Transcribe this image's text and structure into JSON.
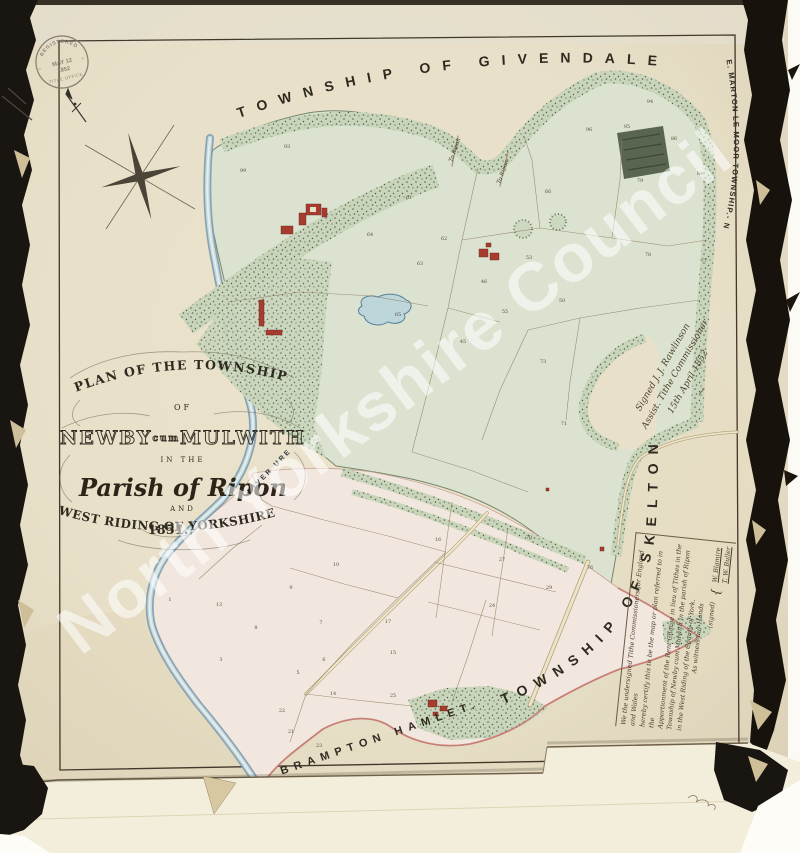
{
  "doc": {
    "watermark": "North Yorkshire Council",
    "stamp": {
      "arc_top": "REGISTERED",
      "line1": "MAY 12",
      "line2": "1852",
      "arc_bottom": "TITHE OFFICE"
    },
    "cartouche": {
      "line1": "PLAN OF THE TOWNSHIP",
      "line2": "OF",
      "name_a": "NEWBY",
      "name_b": "cum",
      "name_c": "MULWITH",
      "line4": "IN THE",
      "line5": "Parish of Ripon",
      "line6": "AND",
      "line7": "WEST RIDING OF YORKSHIRE",
      "line8": "1851."
    },
    "boundary_labels": {
      "north": "TOWNSHIP OF GIVENDALE",
      "northeast": "E. MARTON LE MOOR TOWNSHIP.- N",
      "east": "TOWNSHIP OF SKELTON",
      "south": "BRAMPTON HAMLET."
    },
    "map_labels": {
      "river": "RIVER URE",
      "road_north_1": "To Ripon",
      "road_north_2": "To Ripon"
    },
    "signature_block": {
      "line1": "Signed  J. J. Rawlinson",
      "line2": "Assist. Tithe Commissioner",
      "line3": "15th April 1852",
      "flourish": "~"
    },
    "certification": {
      "lines": [
        "We the undersigned Tithe Commissioners for England and Wales",
        "hereby certify this to be the map or plan referred to in the",
        "Apportionment of the Rent Charge in lieu of Tithes in the",
        "Township of Newby cum Mulwith in the parish of Ripon",
        "in the West Riding of the County of York.",
        "As witness our Hands"
      ],
      "signed_label": "(signed)",
      "signatories": [
        "W. Blamire",
        "T. W. Buller"
      ]
    },
    "parcel_numbers": [
      {
        "n": "93",
        "x": 287,
        "y": 148
      },
      {
        "n": "99",
        "x": 243,
        "y": 172
      },
      {
        "n": "94",
        "x": 650,
        "y": 103
      },
      {
        "n": "95",
        "x": 627,
        "y": 128
      },
      {
        "n": "96",
        "x": 589,
        "y": 131
      },
      {
        "n": "86",
        "x": 674,
        "y": 140
      },
      {
        "n": "84",
        "x": 700,
        "y": 175
      },
      {
        "n": "79",
        "x": 640,
        "y": 182
      },
      {
        "n": "77",
        "x": 704,
        "y": 262
      },
      {
        "n": "78",
        "x": 648,
        "y": 256
      },
      {
        "n": "61",
        "x": 409,
        "y": 199
      },
      {
        "n": "62",
        "x": 444,
        "y": 240
      },
      {
        "n": "63",
        "x": 420,
        "y": 265
      },
      {
        "n": "64",
        "x": 370,
        "y": 236
      },
      {
        "n": "65",
        "x": 398,
        "y": 316
      },
      {
        "n": "66",
        "x": 548,
        "y": 193
      },
      {
        "n": "53",
        "x": 529,
        "y": 259
      },
      {
        "n": "55",
        "x": 505,
        "y": 313
      },
      {
        "n": "46",
        "x": 484,
        "y": 283
      },
      {
        "n": "45",
        "x": 463,
        "y": 343
      },
      {
        "n": "50",
        "x": 562,
        "y": 302
      },
      {
        "n": "71",
        "x": 564,
        "y": 425
      },
      {
        "n": "73",
        "x": 543,
        "y": 363
      },
      {
        "n": "70",
        "x": 529,
        "y": 539
      },
      {
        "n": "76",
        "x": 590,
        "y": 569
      },
      {
        "n": "27",
        "x": 502,
        "y": 561
      },
      {
        "n": "16",
        "x": 438,
        "y": 541
      },
      {
        "n": "29",
        "x": 549,
        "y": 589
      },
      {
        "n": "24",
        "x": 492,
        "y": 607
      },
      {
        "n": "1",
        "x": 170,
        "y": 601
      },
      {
        "n": "13",
        "x": 219,
        "y": 606
      },
      {
        "n": "9",
        "x": 291,
        "y": 589
      },
      {
        "n": "7",
        "x": 321,
        "y": 624
      },
      {
        "n": "8",
        "x": 256,
        "y": 629
      },
      {
        "n": "3",
        "x": 221,
        "y": 661
      },
      {
        "n": "5",
        "x": 298,
        "y": 674
      },
      {
        "n": "6",
        "x": 324,
        "y": 661
      },
      {
        "n": "10",
        "x": 336,
        "y": 566
      },
      {
        "n": "17",
        "x": 388,
        "y": 623
      },
      {
        "n": "15",
        "x": 393,
        "y": 654
      },
      {
        "n": "25",
        "x": 393,
        "y": 697
      },
      {
        "n": "14",
        "x": 333,
        "y": 695
      },
      {
        "n": "21",
        "x": 291,
        "y": 733
      },
      {
        "n": "23",
        "x": 319,
        "y": 747
      },
      {
        "n": "22",
        "x": 282,
        "y": 712
      }
    ],
    "colors": {
      "paper": "#e9e1c9",
      "green_area": "#dbe3d0",
      "pink_area": "#f1e7de",
      "river": "#7e9cb0",
      "building_red": "#a63c2f",
      "ink": "#2f2a20",
      "watermark_white": "rgba(255,255,255,0.55)"
    }
  }
}
